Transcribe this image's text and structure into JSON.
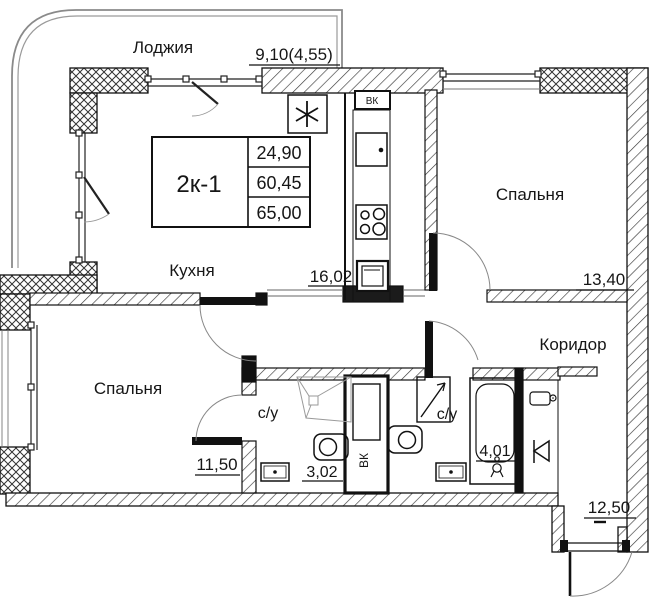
{
  "plan": {
    "summary_table": {
      "unit": "2к-1",
      "rows": [
        "24,90",
        "60,45",
        "65,00"
      ]
    },
    "rooms": {
      "loggia": {
        "label": "Лоджия",
        "area": "9,10(4,55)"
      },
      "kitchen": {
        "label": "Кухня",
        "area": "16,02"
      },
      "bedroom1": {
        "label": "Спальня",
        "area": "11,50"
      },
      "bedroom2": {
        "label": "Спальня",
        "area": "13,40"
      },
      "corridor": {
        "label": "Коридор",
        "area": "12,50"
      },
      "bath1": {
        "label": "с/у",
        "area": "3,02"
      },
      "bath2": {
        "label": "с/у",
        "area": "4,01"
      }
    },
    "markers": {
      "vent_box": "ВК",
      "vent_shaft": "ВК",
      "fridge_symbol": "✳"
    }
  }
}
